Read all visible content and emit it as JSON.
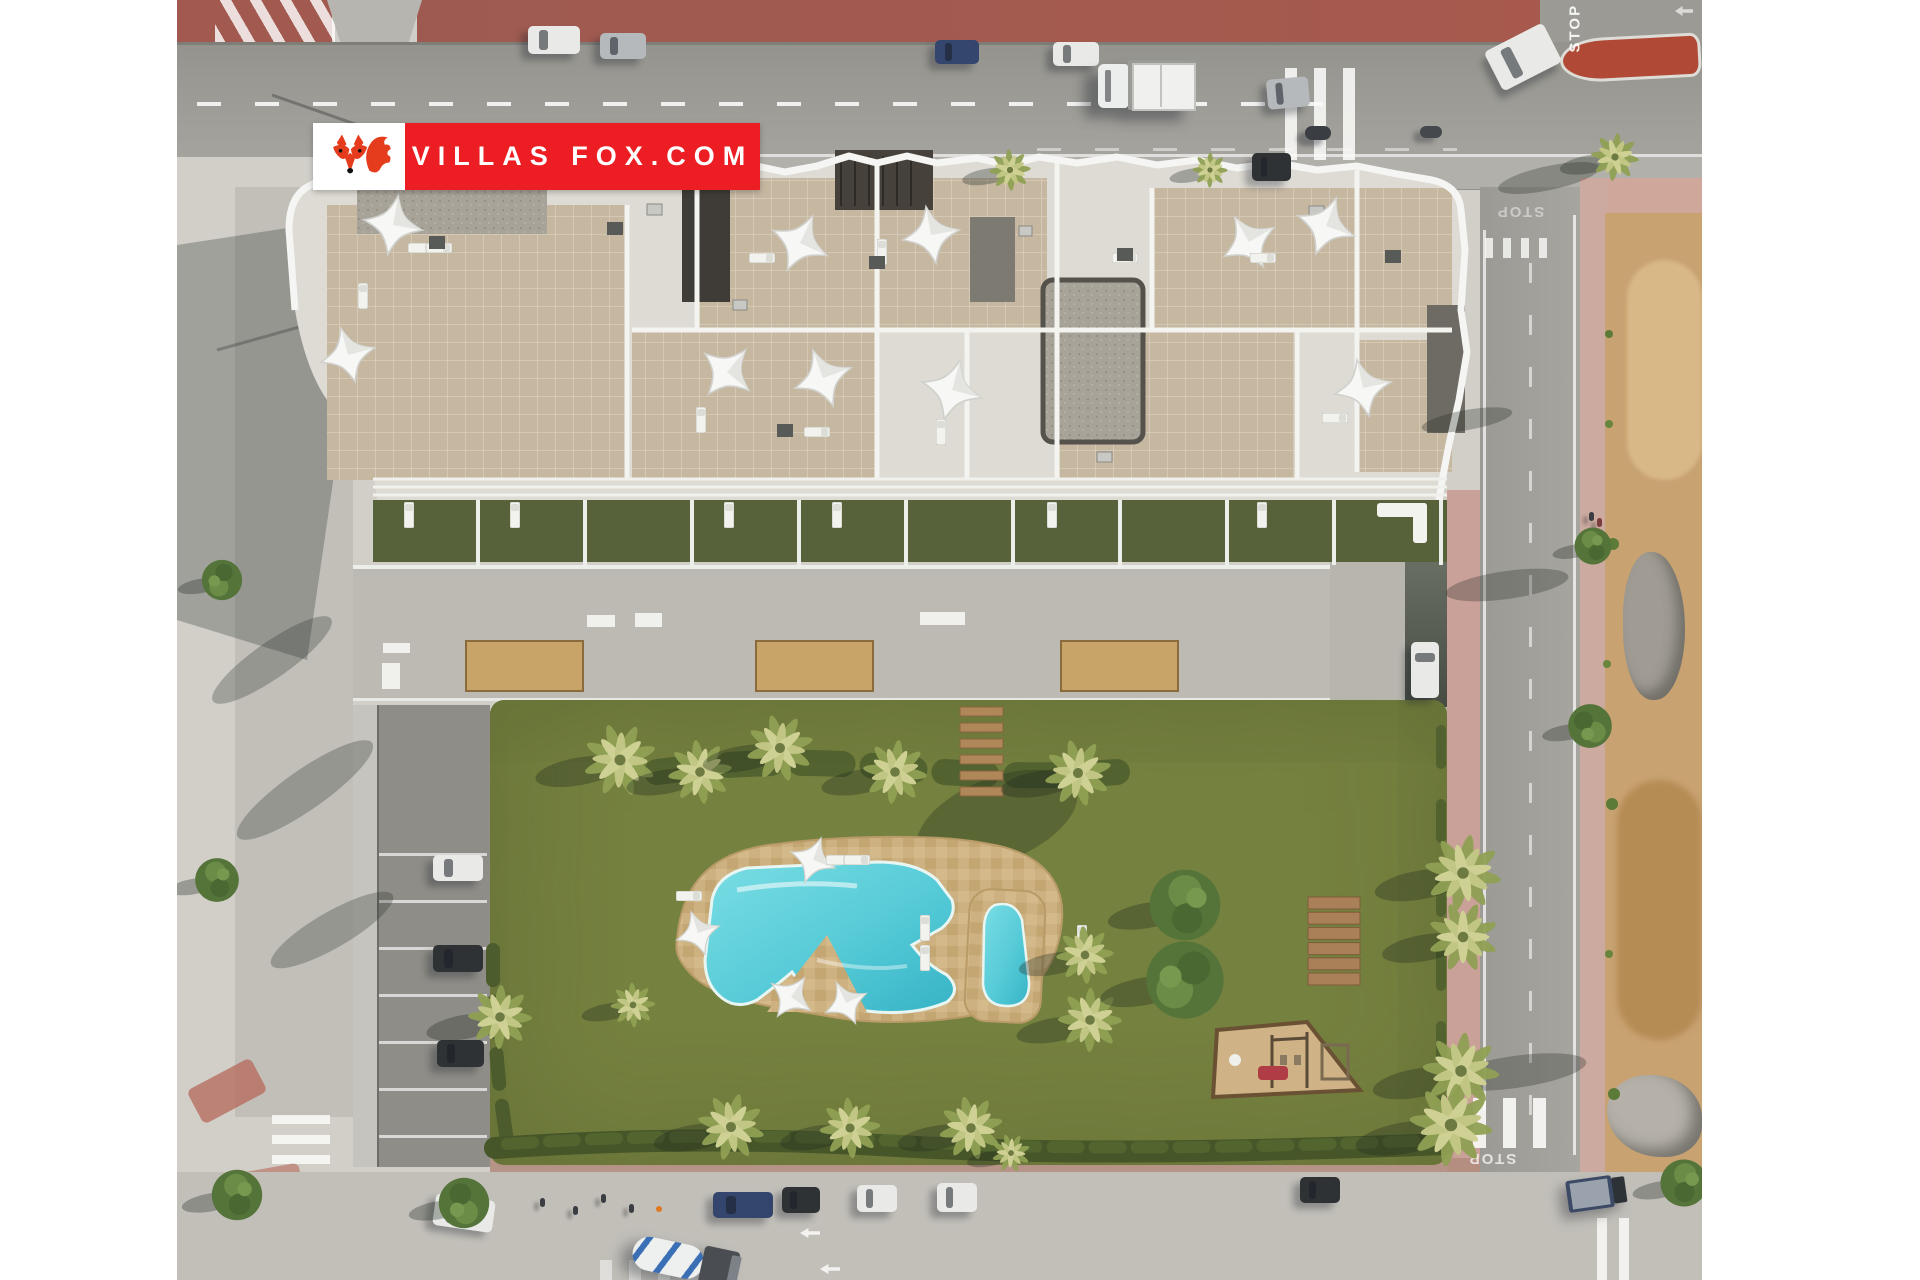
{
  "scene": {
    "title": "Aerial render of a new-build apartment complex with communal pool and gardens",
    "type": "real-estate marketing aerial photo"
  },
  "logo": {
    "text": "VILLAS FOX.COM",
    "icon": "fox-logo-icon"
  },
  "road_markings": {
    "stop": "STOP"
  },
  "palette": {
    "pavement": "#d2cfc9",
    "road-top": "#9b9a94",
    "road-light": "#c2bfb9",
    "road-right": "#a3a19b",
    "sidewalk-top": "#b2b0ab",
    "red-sidewalk": "#a25a50",
    "red-island": "#b04a36",
    "brick-pink": "#cfa79b",
    "building-white": "#eceeec",
    "roof-tan": "#c6b7a1",
    "gravel": "#a8a399",
    "gravel-dark": "#6e6b64",
    "dark-box": "#403d38",
    "terrace-green": "#57623a",
    "deck": "#bdbab4",
    "planter-sand": "#c9a468",
    "garden": "#75813f",
    "hedge": "#465629",
    "pool-sand": "#cdb180",
    "pool": "#56cbd7",
    "pool-deep": "#36b3c6",
    "wood": "#a98057",
    "dirt": "#c8a271",
    "rubble": "#a09c94",
    "logo-red": "#ec1d23",
    "logo-box": "#ffffff",
    "fox-red": "#e63c1e"
  }
}
